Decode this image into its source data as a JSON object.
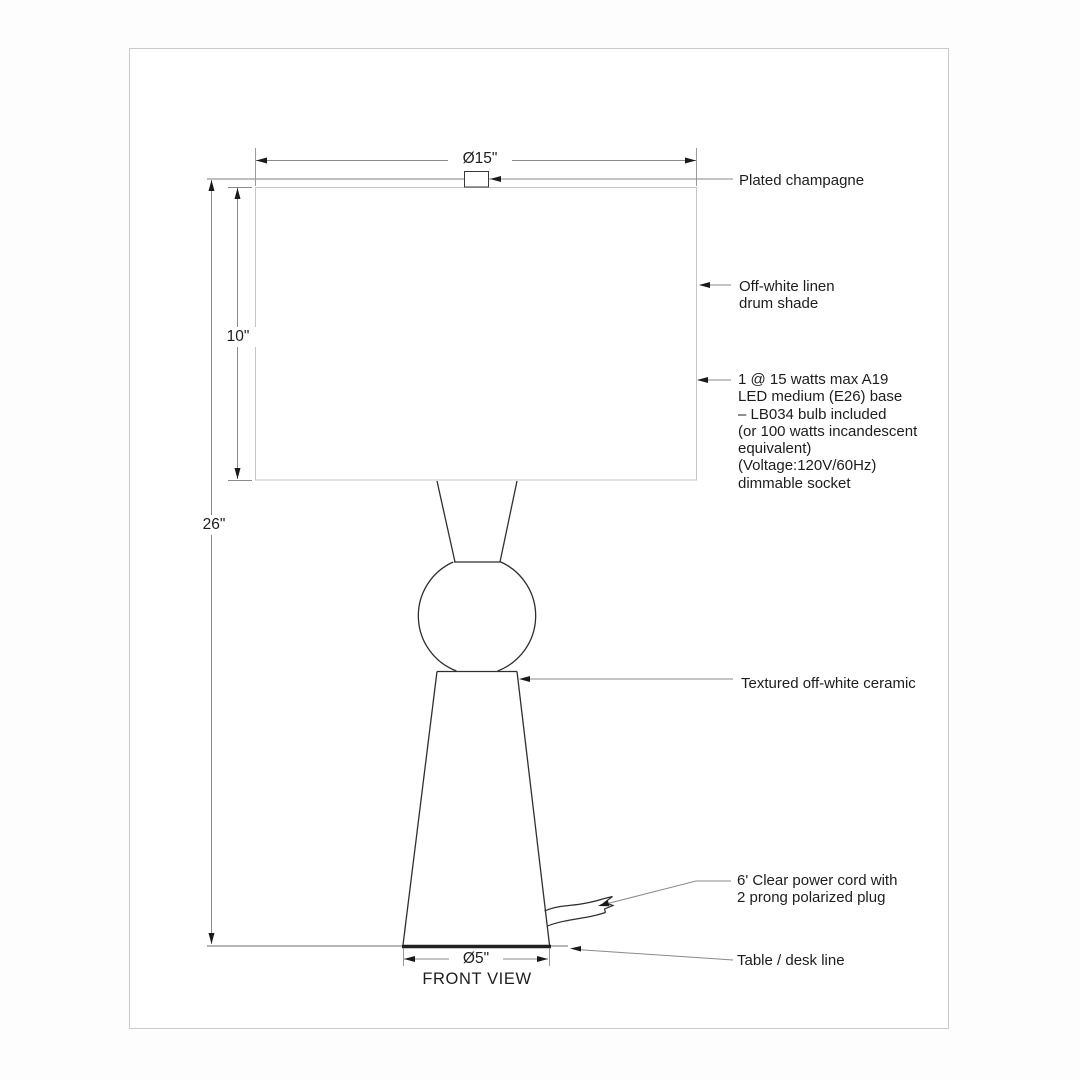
{
  "drawing": {
    "title": "FRONT VIEW",
    "dimensions": {
      "shade_diameter": "Ø15\"",
      "shade_height": "10\"",
      "overall_height": "26\"",
      "base_diameter": "Ø5\""
    },
    "callouts": {
      "finial": "Plated champagne",
      "shade": "Off-white linen\ndrum shade",
      "bulb": "1 @ 15 watts max A19\nLED medium (E26) base\n– LB034 bulb included\n(or 100 watts incandescent\nequivalent)\n(Voltage:120V/60Hz)\ndimmable socket",
      "body": "Textured off-white ceramic",
      "cord": "6' Clear power cord with\n2 prong polarized plug",
      "table": "Table / desk line"
    },
    "colors": {
      "line_dark": "#2f2f2f",
      "line_dim": "#8a8a8a",
      "line_light": "#c6c6c6",
      "arrow": "#1a1a1a",
      "text": "#1d1d1d",
      "frame_border": "#cacaca"
    }
  }
}
